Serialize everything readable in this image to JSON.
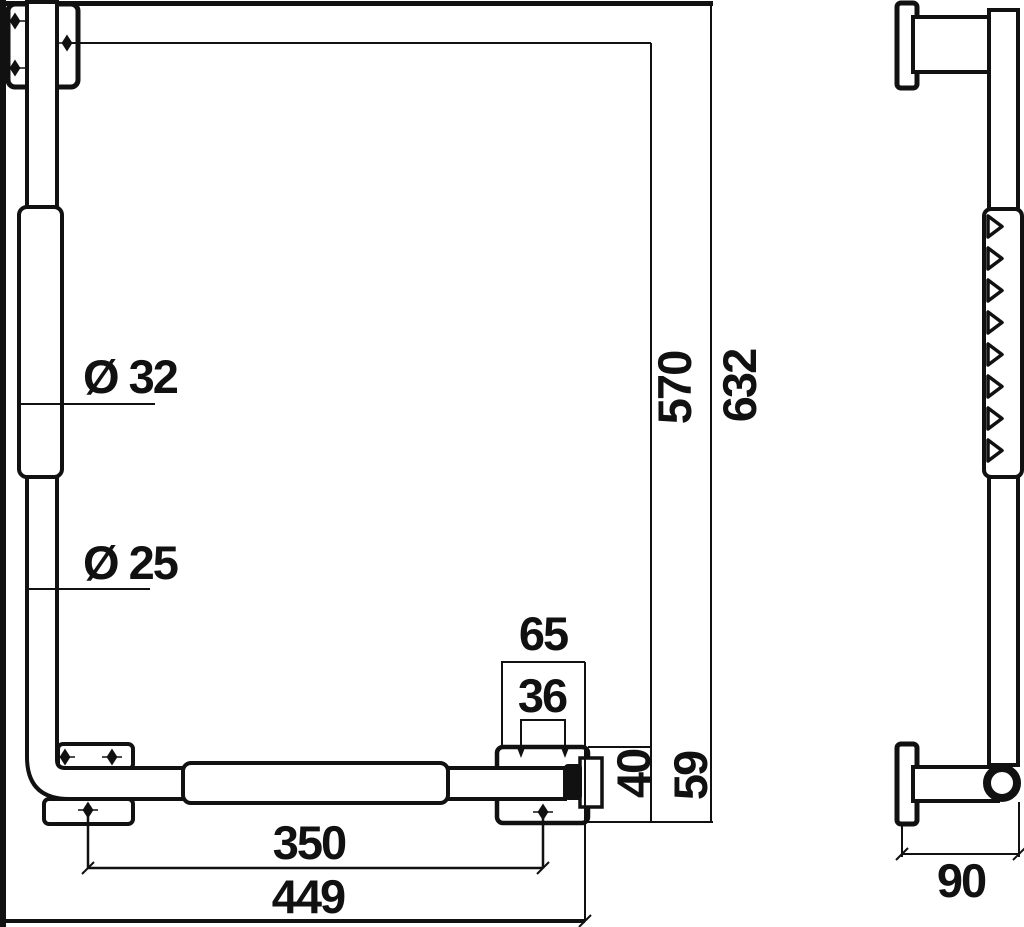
{
  "meta": {
    "type": "technical dimension drawing",
    "subject": "wall-mounted L-shaped grab bar, front and side elevation",
    "background_color": "#ffffff",
    "line_color": "#111111"
  },
  "front_view": {
    "labels": {
      "grip_diameter": "Ø 32",
      "tube_diameter": "Ø 25",
      "plate_width": "65",
      "hole_spacing": "36",
      "bar_span": "350",
      "overall_width": "449",
      "inner_height": "570",
      "overall_height": "632",
      "end_offset": "40",
      "end_height": "59"
    }
  },
  "side_view": {
    "labels": {
      "wall_offset": "90"
    }
  }
}
